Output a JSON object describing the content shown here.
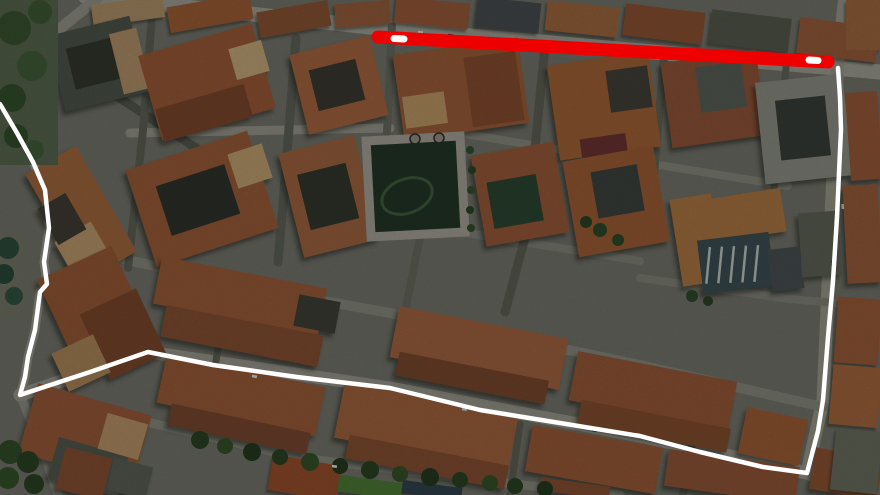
{
  "map": {
    "overlay": {
      "route": {
        "label": "white-route-outline",
        "color": "#ffffff",
        "width": 4.5,
        "points": "0,104 17,133 33,162 45,190 49,228 44,262 47,284 40,292 35,330 28,357 25,377 20,395 90,372 148,352 213,365 297,377 390,388 480,410 560,423 640,436 700,452 763,467 807,473 818,431 823,400 828,337 833,281 837,217 840,151 841,130 840,97 838,68"
      },
      "highlight": {
        "label": "red-highlighted-street",
        "color": "#ee0000",
        "width": 13,
        "points": "378,37 610,50 828,62"
      },
      "highlight_gaps": [
        {
          "points": "394,38.5 404,39",
          "color": "#ffffff",
          "width": 7
        },
        {
          "points": "809,60 818,60.5",
          "color": "#ffffff",
          "width": 7
        }
      ]
    },
    "palette": {
      "ground": "#75766c",
      "street_light": "#9f9e92",
      "street_dark": "#5f6357",
      "roof": "#9c5c38",
      "park": "#233728"
    }
  }
}
